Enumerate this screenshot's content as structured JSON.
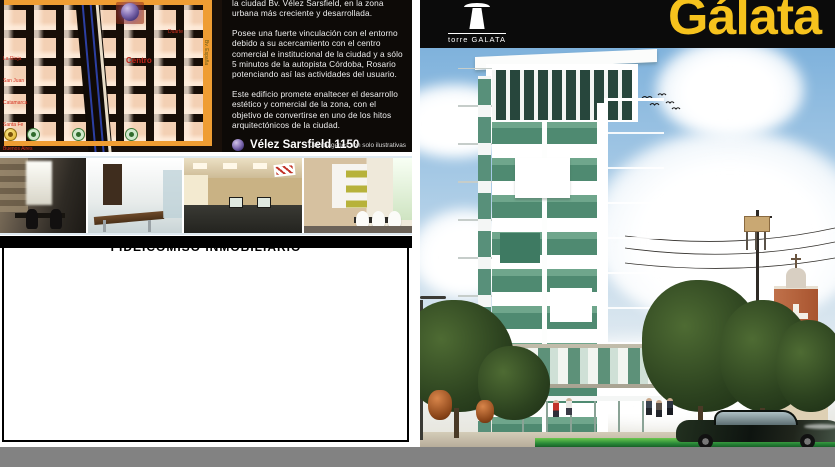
{
  "brand": {
    "title": "Gálata",
    "logo_text": "torre GALATA",
    "accent_yellow": "#F6C21D"
  },
  "info_panel": {
    "paragraph_1": "la ciudad Bv. Vélez Sarsfield, en la zona urbana más creciente y desarrollada.",
    "paragraph_2": "Posee una fuerte vinculación con el entorno debido a su acercamiento con el centro comercial e institucional de la ciudad y a sólo 5 minutos de la autopista Córdoba, Rosario potenciando  así las actividades del usuario.",
    "paragraph_3": "Este edificio promete enaltecer el desarrollo estético y comercial de la zona, con el objetivo de convertirse en uno de los hitos arquitectónicos de la ciudad.",
    "address": "Vélez Sarsfield 1150",
    "disclaimer": "Las imágenes son solo ilustrativas"
  },
  "section_heading": "FIDEICOMISO INMOBILIARIO",
  "map": {
    "labels": {
      "centro": "Centro",
      "duarte": "Duarte",
      "la_rioja": "La Rioja",
      "san_juan": "San Juan",
      "catamarca": "Catamarca",
      "santa_fe": "Santa Fe",
      "buenos_aires": "Buenos Aires",
      "bv_espana": "Bv. España"
    },
    "marker_icon": "location-sphere-icon",
    "road_color": "#EF9D33",
    "block_color": "#F3D0B4"
  },
  "colors": {
    "building_glass_green": "#5C937C",
    "lawn_green": "#2A8A38",
    "bottom_bar_gray": "#828282",
    "header_black": "#0B0B0B"
  }
}
